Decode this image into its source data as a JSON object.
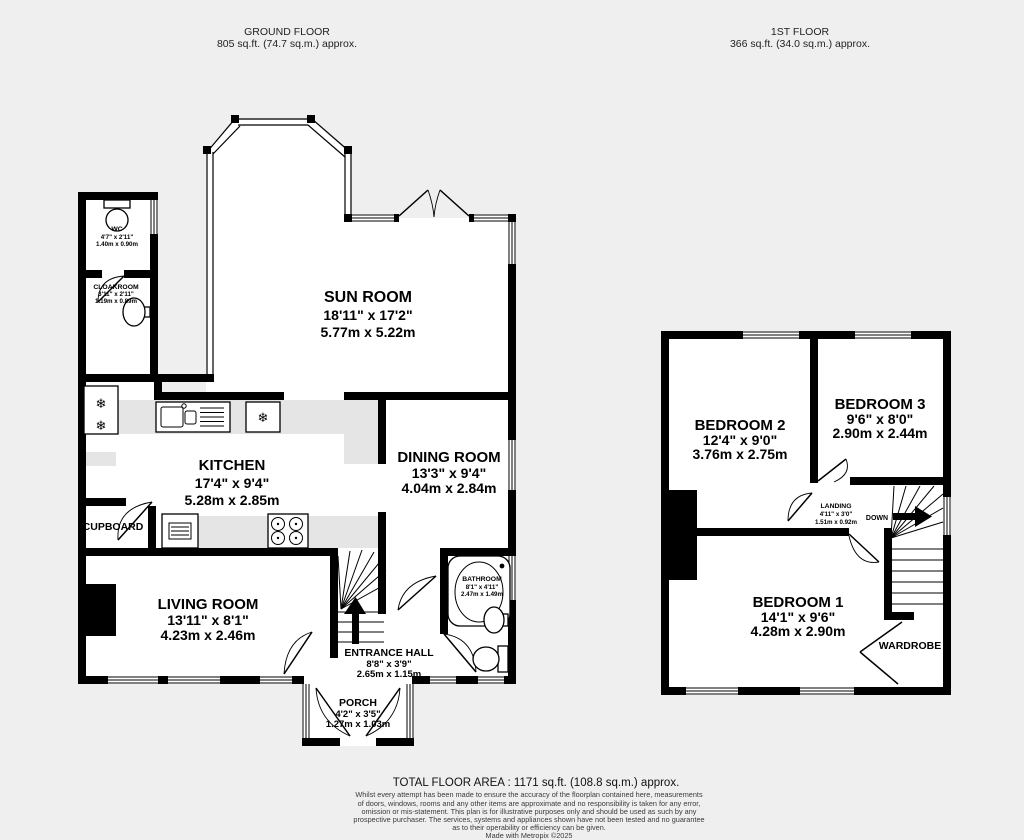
{
  "floors": {
    "ground": {
      "title": "GROUND FLOOR",
      "area": "805 sq.ft. (74.7 sq.m.) approx."
    },
    "first": {
      "title": "1ST FLOOR",
      "area": "366 sq.ft. (34.0 sq.m.) approx."
    }
  },
  "rooms": {
    "sun_room": {
      "name": "SUN ROOM",
      "imperial": "18'11\"  x 17'2\"",
      "metric": "5.77m  x 5.22m"
    },
    "kitchen": {
      "name": "KITCHEN",
      "imperial": "17'4\"  x 9'4\"",
      "metric": "5.28m  x 2.85m"
    },
    "dining_room": {
      "name": "DINING ROOM",
      "imperial": "13'3\"  x 9'4\"",
      "metric": "4.04m  x 2.84m"
    },
    "living_room": {
      "name": "LIVING ROOM",
      "imperial": "13'11\"  x 8'1\"",
      "metric": "4.23m  x 2.46m"
    },
    "entrance_hall": {
      "name": "ENTRANCE HALL",
      "imperial": "8'8\"  x 3'9\"",
      "metric": "2.65m  x 1.15m"
    },
    "porch": {
      "name": "PORCH",
      "imperial": "4'2\"  x 3'5\"",
      "metric": "1.27m  x 1.03m"
    },
    "bathroom": {
      "name": "BATHROOM",
      "imperial": "8'1\"  x 4'11\"",
      "metric": "2.47m  x 1.49m"
    },
    "wc": {
      "name": "WC",
      "imperial": "4'7\"  x 2'11\"",
      "metric": "1.40m  x 0.90m"
    },
    "cloakroom": {
      "name": "CLOAKROOM",
      "imperial": "3'11\"  x 2'11\"",
      "metric": "1.19m  x 0.89m"
    },
    "cupboard": {
      "name": "CUPBOARD"
    },
    "bedroom_1": {
      "name": "BEDROOM 1",
      "imperial": "14'1\"  x 9'6\"",
      "metric": "4.28m  x 2.90m"
    },
    "bedroom_2": {
      "name": "BEDROOM 2",
      "imperial": "12'4\"  x 9'0\"",
      "metric": "3.76m  x 2.75m"
    },
    "bedroom_3": {
      "name": "BEDROOM 3",
      "imperial": "9'6\"  x 8'0\"",
      "metric": "2.90m  x 2.44m"
    },
    "landing": {
      "name": "LANDING",
      "imperial": "4'11\"  x 3'0\"",
      "metric": "1.51m  x 0.92m"
    },
    "wardrobe": {
      "name": "WARDROBE"
    },
    "stairs": {
      "down_label": "DOWN"
    }
  },
  "icons": {
    "snowflake": "❄"
  },
  "footer": {
    "total_area": "TOTAL FLOOR AREA : 1171 sq.ft. (108.8 sq.m.) approx.",
    "disclaimer_lines": [
      "Whilst every attempt has been made to ensure the accuracy of the floorplan contained here, measurements",
      "of doors, windows, rooms and any other items are approximate and no responsibility is taken for any error,",
      "omission or mis-statement. This plan is for illustrative purposes only and should be used as such by any",
      "prospective purchaser. The services, systems and appliances shown have not been tested and no guarantee",
      "as to their operability or efficiency can be given."
    ],
    "credit": "Made with Metropix ©2025"
  },
  "colors": {
    "wall": "#000000",
    "room_fill": "#ffffff",
    "counter": "#e5e5e5",
    "background": "#efefef"
  }
}
